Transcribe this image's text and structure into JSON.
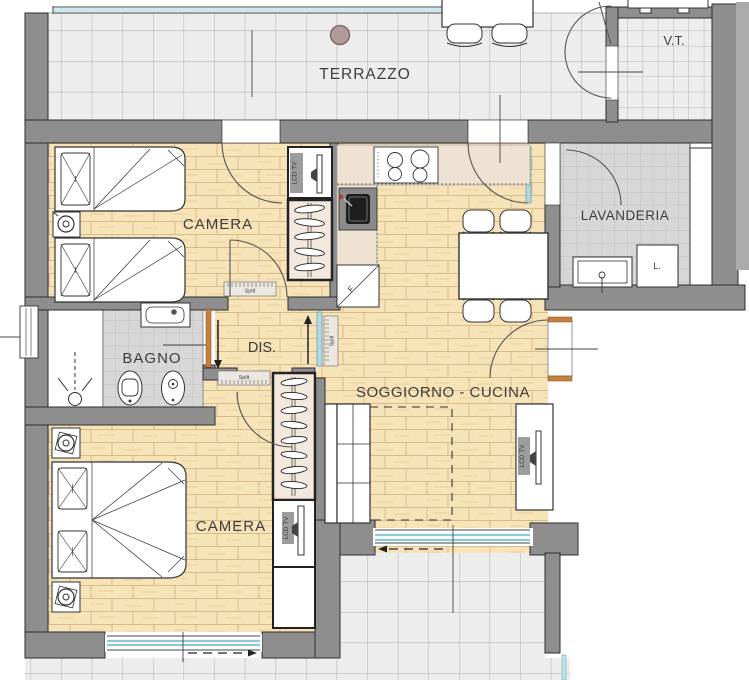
{
  "plan": {
    "rooms": {
      "terrazzo": {
        "label": "TERRAZZO"
      },
      "vt": {
        "label": "V.T."
      },
      "camera1": {
        "label": "CAMERA"
      },
      "camera2": {
        "label": "CAMERA"
      },
      "lavanderia": {
        "label": "LAVANDERIA"
      },
      "bagno": {
        "label": "BAGNO"
      },
      "dis": {
        "label": "DIS."
      },
      "soggiorno": {
        "label": "SOGGIORNO - CUCINA"
      }
    },
    "equipment": {
      "lcd_tv": "LCD TV",
      "split": "Split",
      "fridge": "F",
      "washer": "L."
    },
    "colors": {
      "wall": "#8e8e8e",
      "wall_edge": "#ababab",
      "wood_floor": "#f7e3b8",
      "tile_light": "#ededed",
      "tile_gray": "#d7d7d7",
      "glass": "#aed9e6",
      "door_wood": "#c8803c",
      "label_text": "#3d3d3d",
      "terrace_column_dot": "#b29a9a"
    }
  }
}
